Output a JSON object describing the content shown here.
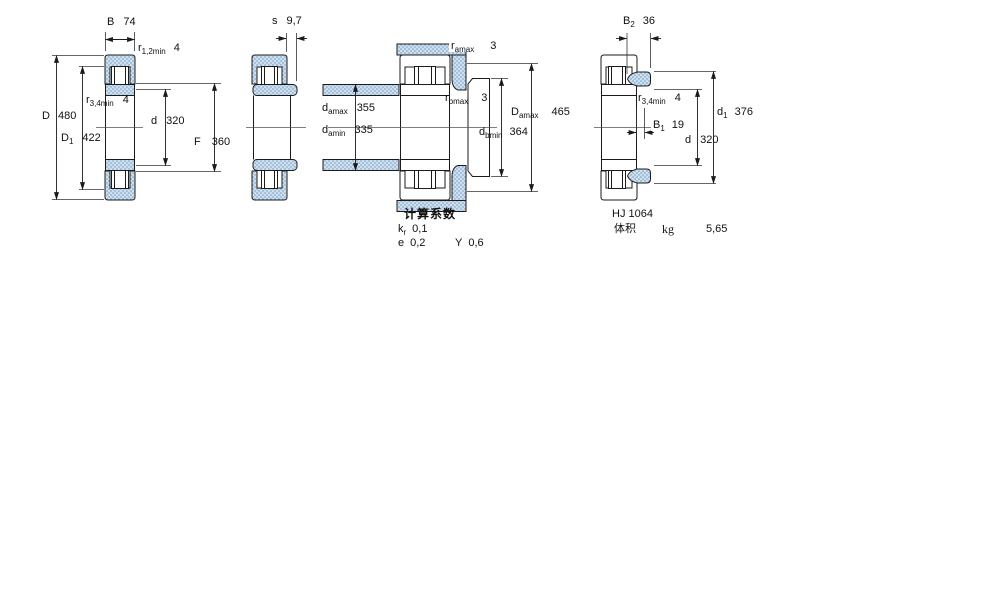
{
  "page": {
    "background": "#ffffff",
    "line_color": "#1b1b1b",
    "hatch_fill": "#cddfee",
    "hatch_dot": "#86a9c9"
  },
  "drawings": {
    "main_section": {
      "description": "cylindrical-roller-bearing-cross-section",
      "dims": {
        "B": {
          "base": "B",
          "sub": "",
          "value": "74"
        },
        "r12": {
          "base": "r",
          "sub": "1,2min",
          "value": "4"
        },
        "r34": {
          "base": "r",
          "sub": "3,4min",
          "value": "4"
        },
        "D": {
          "base": "D",
          "sub": "",
          "value": "480"
        },
        "D1": {
          "base": "D",
          "sub": "1",
          "value": "422"
        },
        "d": {
          "base": "d",
          "sub": "",
          "value": "320"
        },
        "F": {
          "base": "F",
          "sub": "",
          "value": "360"
        }
      }
    },
    "side_view": {
      "description": "bearing-profile-view",
      "dims": {
        "s": {
          "base": "s",
          "sub": "",
          "value": "9,7"
        }
      }
    },
    "mounting": {
      "description": "mounting-abutment-dimensions",
      "dims": {
        "r_amax": {
          "base": "r",
          "sub": "amax",
          "value": "3"
        },
        "r_bmax": {
          "base": "r",
          "sub": "bmax",
          "value": "3"
        },
        "d_amax": {
          "base": "d",
          "sub": "amax",
          "value": "355"
        },
        "d_amin": {
          "base": "d",
          "sub": "amin",
          "value": "335"
        },
        "D_amax": {
          "base": "D",
          "sub": "amax",
          "value": "465"
        },
        "d_bmin": {
          "base": "d",
          "sub": "bmin",
          "value": "364"
        }
      },
      "calc_factors": {
        "heading": "计算系数",
        "k_r": {
          "base": "k",
          "sub": "r",
          "value": "0,1"
        },
        "e": {
          "base": "e",
          "sub": "",
          "value": "0,2"
        },
        "Y": {
          "base": "Y",
          "sub": "",
          "value": "0,6"
        }
      }
    },
    "angle_ring": {
      "title": "HJ 1064",
      "dims": {
        "B2": {
          "base": "B",
          "sub": "2",
          "value": "36"
        },
        "r34": {
          "base": "r",
          "sub": "3,4min",
          "value": "4"
        },
        "B1": {
          "base": "B",
          "sub": "1",
          "value": "19"
        },
        "d1": {
          "base": "d",
          "sub": "1",
          "value": "376"
        },
        "d": {
          "base": "d",
          "sub": "",
          "value": "320"
        }
      },
      "properties": {
        "volume_label": "体积",
        "unit": "kg",
        "value": "5,65"
      }
    }
  }
}
